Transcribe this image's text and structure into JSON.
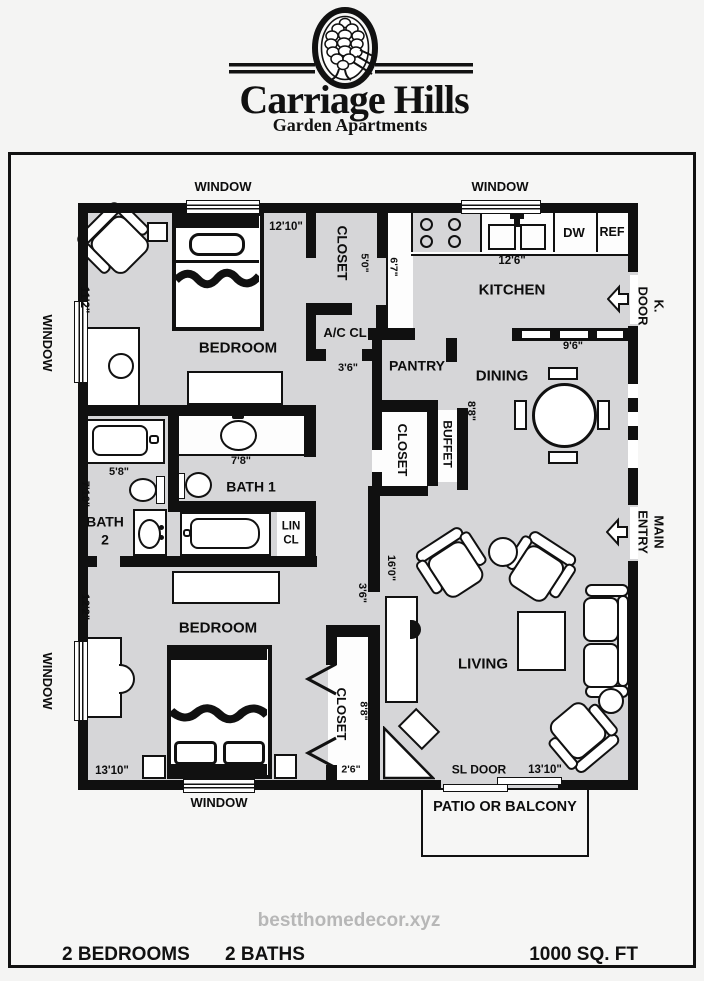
{
  "logo": {
    "title": "Carriage Hills",
    "subtitle": "Garden Apartments",
    "emblem": "pinecone-in-oval"
  },
  "watermark": "bestthomedecor.xyz",
  "footer": {
    "bedrooms": "2 BEDROOMS",
    "baths": "2 BATHS",
    "area": "1000 SQ. FT"
  },
  "plan": {
    "window_labels": {
      "top_left": "WINDOW",
      "top_right": "WINDOW",
      "left_upper": "WINDOW",
      "left_lower": "WINDOW",
      "bottom": "WINDOW"
    },
    "rooms": {
      "bedroom1": "BEDROOM",
      "bedroom2": "BEDROOM",
      "kitchen": "KITCHEN",
      "dining": "DINING",
      "living": "LIVING",
      "pantry": "PANTRY",
      "bath1": "BATH 1",
      "bath2": "BATH\n2"
    },
    "storage": {
      "closet_top": "CLOSET",
      "closet_mid": "CLOSET",
      "closet_bed2": "CLOSET",
      "buffet": "BUFFET",
      "ac_cl": "A/C CL",
      "lin_cl": "LIN\nCL"
    },
    "doors": {
      "k_door": "K. DOOR",
      "main_entry": "MAIN ENTRY",
      "sl_door": "SL DOOR"
    },
    "appliances": {
      "dw": "DW",
      "ref": "REF"
    },
    "outdoor": {
      "patio": "PATIO OR BALCONY"
    },
    "dims": {
      "bedroom1_w": "12'10\"",
      "bedroom1_d": "11'2\"",
      "closet_top": "5'0\"",
      "counter": "6'7\"",
      "kitchen_w": "12'6\"",
      "ac_w": "3'6\"",
      "dining_w": "9'6\"",
      "dining_d": "8'8\"",
      "tub2": "5'8\"",
      "vanity1": "7'8\"",
      "bath2_d": "7'10\"",
      "bedroom2_d": "12'2\"",
      "living_d": "16'0\"",
      "hall_w": "3'6\"",
      "closet2_d": "8'8\"",
      "closet2_w": "2'6\"",
      "bedroom2_w": "13'10\"",
      "living_w": "13'10\""
    },
    "colors": {
      "floor": "#d6d6d8",
      "wall": "#101010",
      "paper": "#f6f6f5"
    }
  }
}
